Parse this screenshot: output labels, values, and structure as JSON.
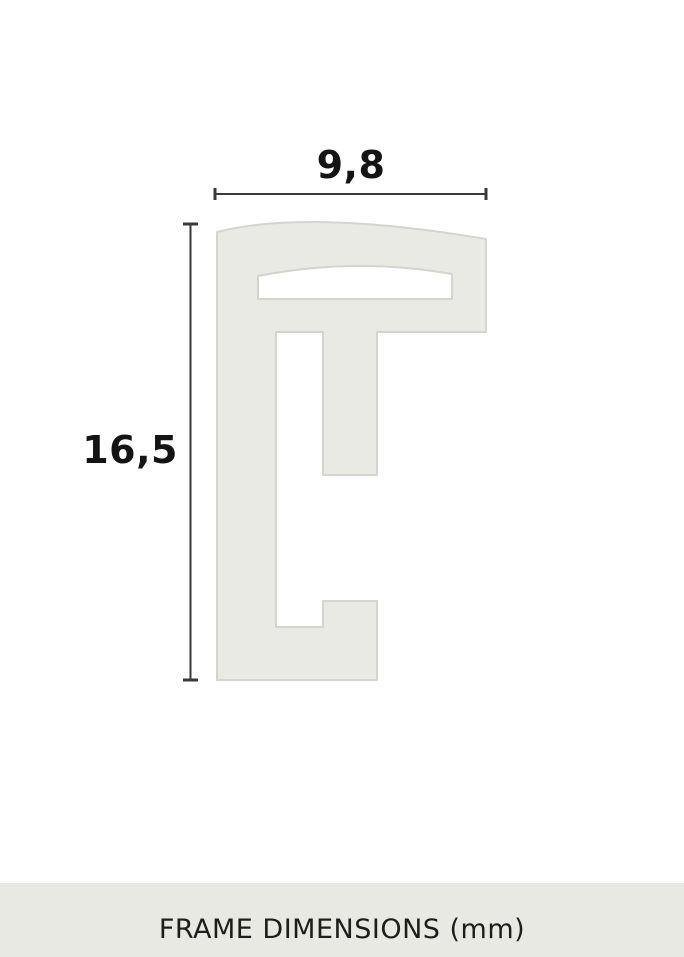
{
  "page": {
    "background": "#ffffff"
  },
  "diagram": {
    "type": "frame-profile-cross-section",
    "width_dimension": {
      "label": "9,8",
      "value_mm": 9.8
    },
    "height_dimension": {
      "label": "16,5",
      "value_mm": 16.5
    },
    "profile_fill": "#e9eae4",
    "profile_stroke": "#d3d5ce",
    "dimension_line_color": "#3a3a3a",
    "label_color": "#141414"
  },
  "caption": {
    "text": "FRAME DIMENSIONS (mm)",
    "background": "#e8e9e3",
    "text_color": "#1d1d1b"
  }
}
